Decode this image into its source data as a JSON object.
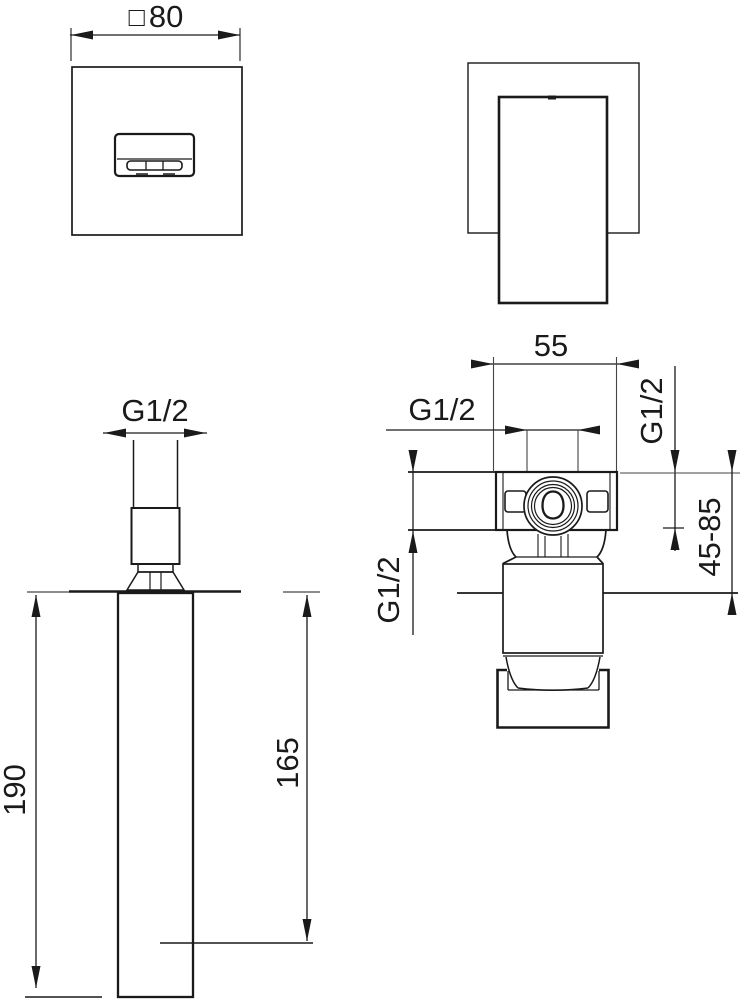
{
  "colors": {
    "line_color": "#1a1a1a",
    "background": "#ffffff"
  },
  "labels": {
    "front_width_symbol": "□",
    "front_width": "80",
    "spout": {
      "thread": "G1/2",
      "total_height": "190",
      "projection": "165"
    },
    "valve": {
      "width": "55",
      "top_thread": "G1/2",
      "bottom_thread": "G1/2",
      "side_thread": "G1/2",
      "install_depth": "45-85"
    }
  }
}
